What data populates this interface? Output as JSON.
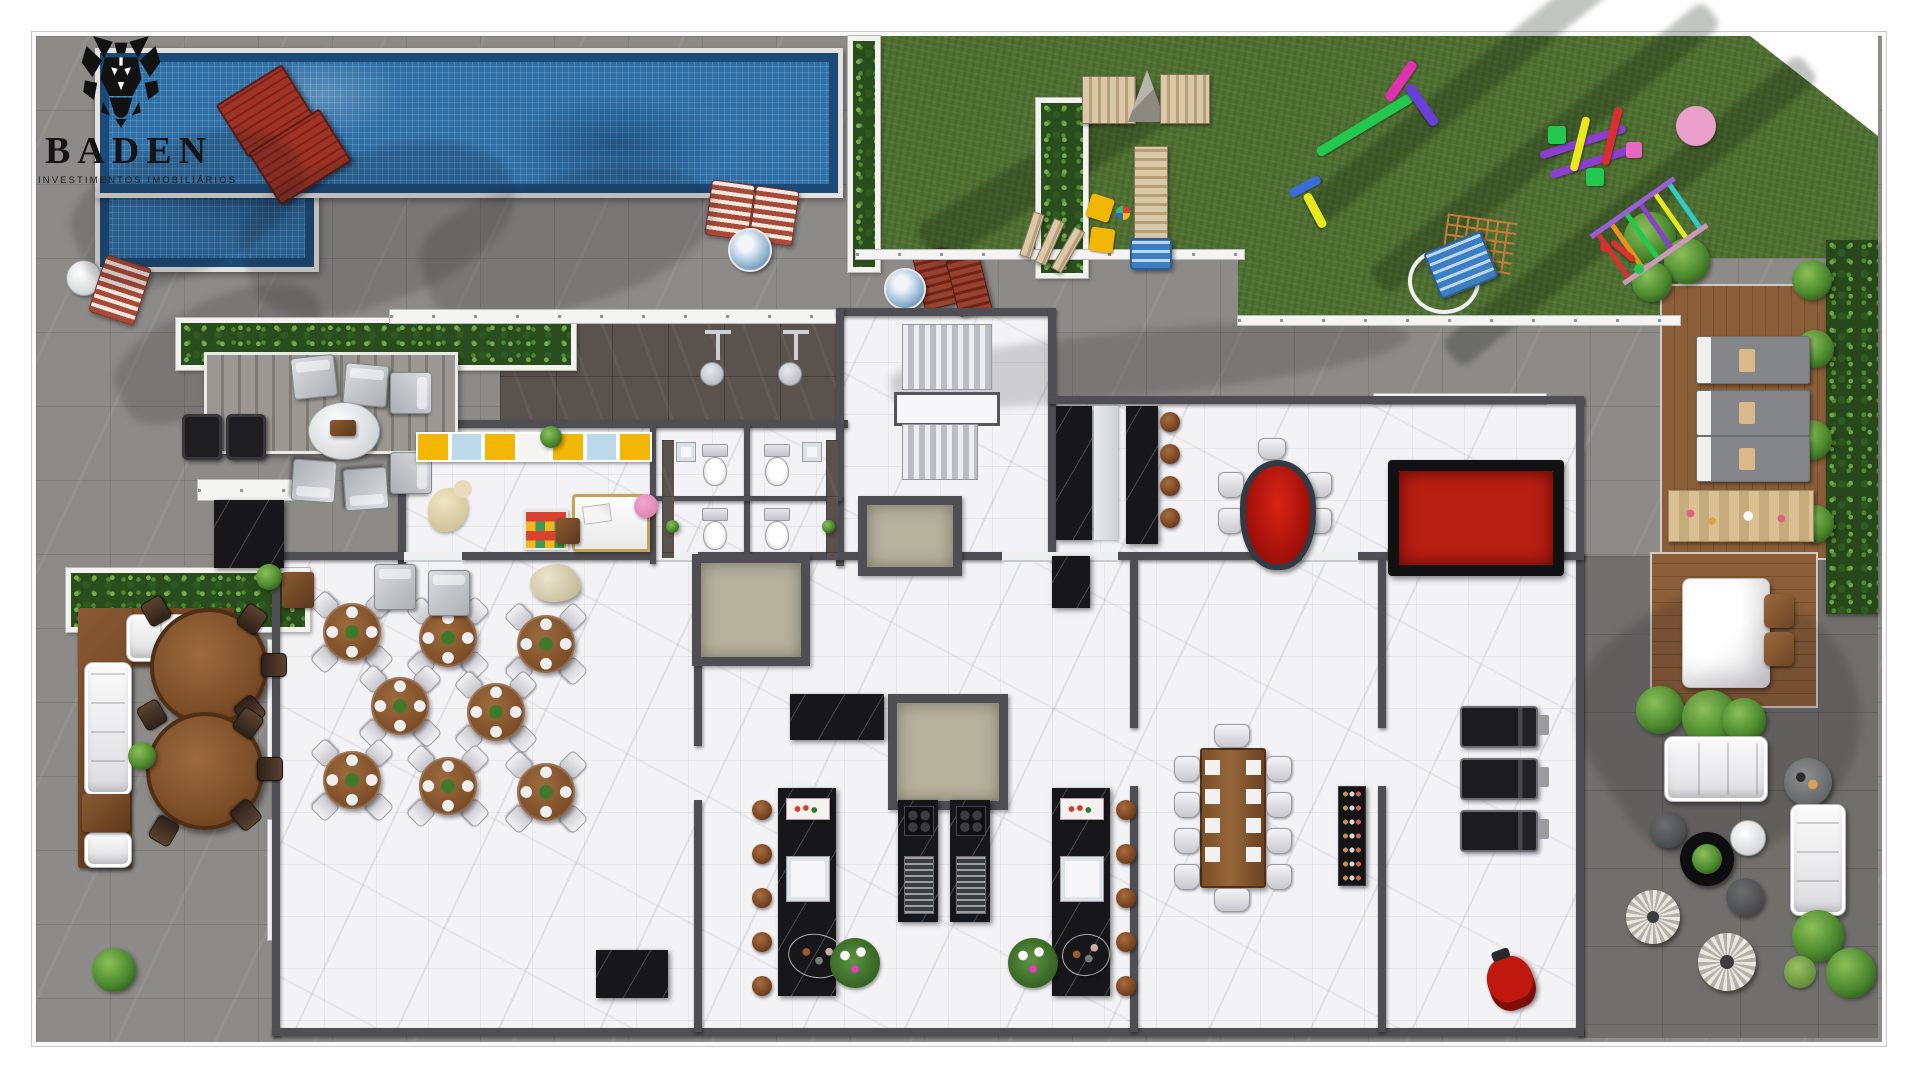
{
  "brand": {
    "name": "BADEN",
    "tagline": "INVESTIMENTOS IMOBILIÁRIOS"
  },
  "palette": {
    "pool": "#2e6fa5",
    "poolRim": "#1c4a77",
    "grass": "#4e7030",
    "hedgeGreen": "#2c5c1b",
    "plantGreen": "#4c8a2e",
    "stone": "#8d8b88",
    "terrace": "#716f6b",
    "showerTile": "#5a524c",
    "marble": "#f3f3f5",
    "wall": "#4f4f53",
    "blackMarble": "#17171a",
    "wood": "#7c4e28",
    "deckWood": "#8a5e38",
    "accentRed": "#b81f13",
    "yellow": "#f2b705",
    "shaftBeige": "#b5b19d",
    "white": "#f6f6f4"
  }
}
